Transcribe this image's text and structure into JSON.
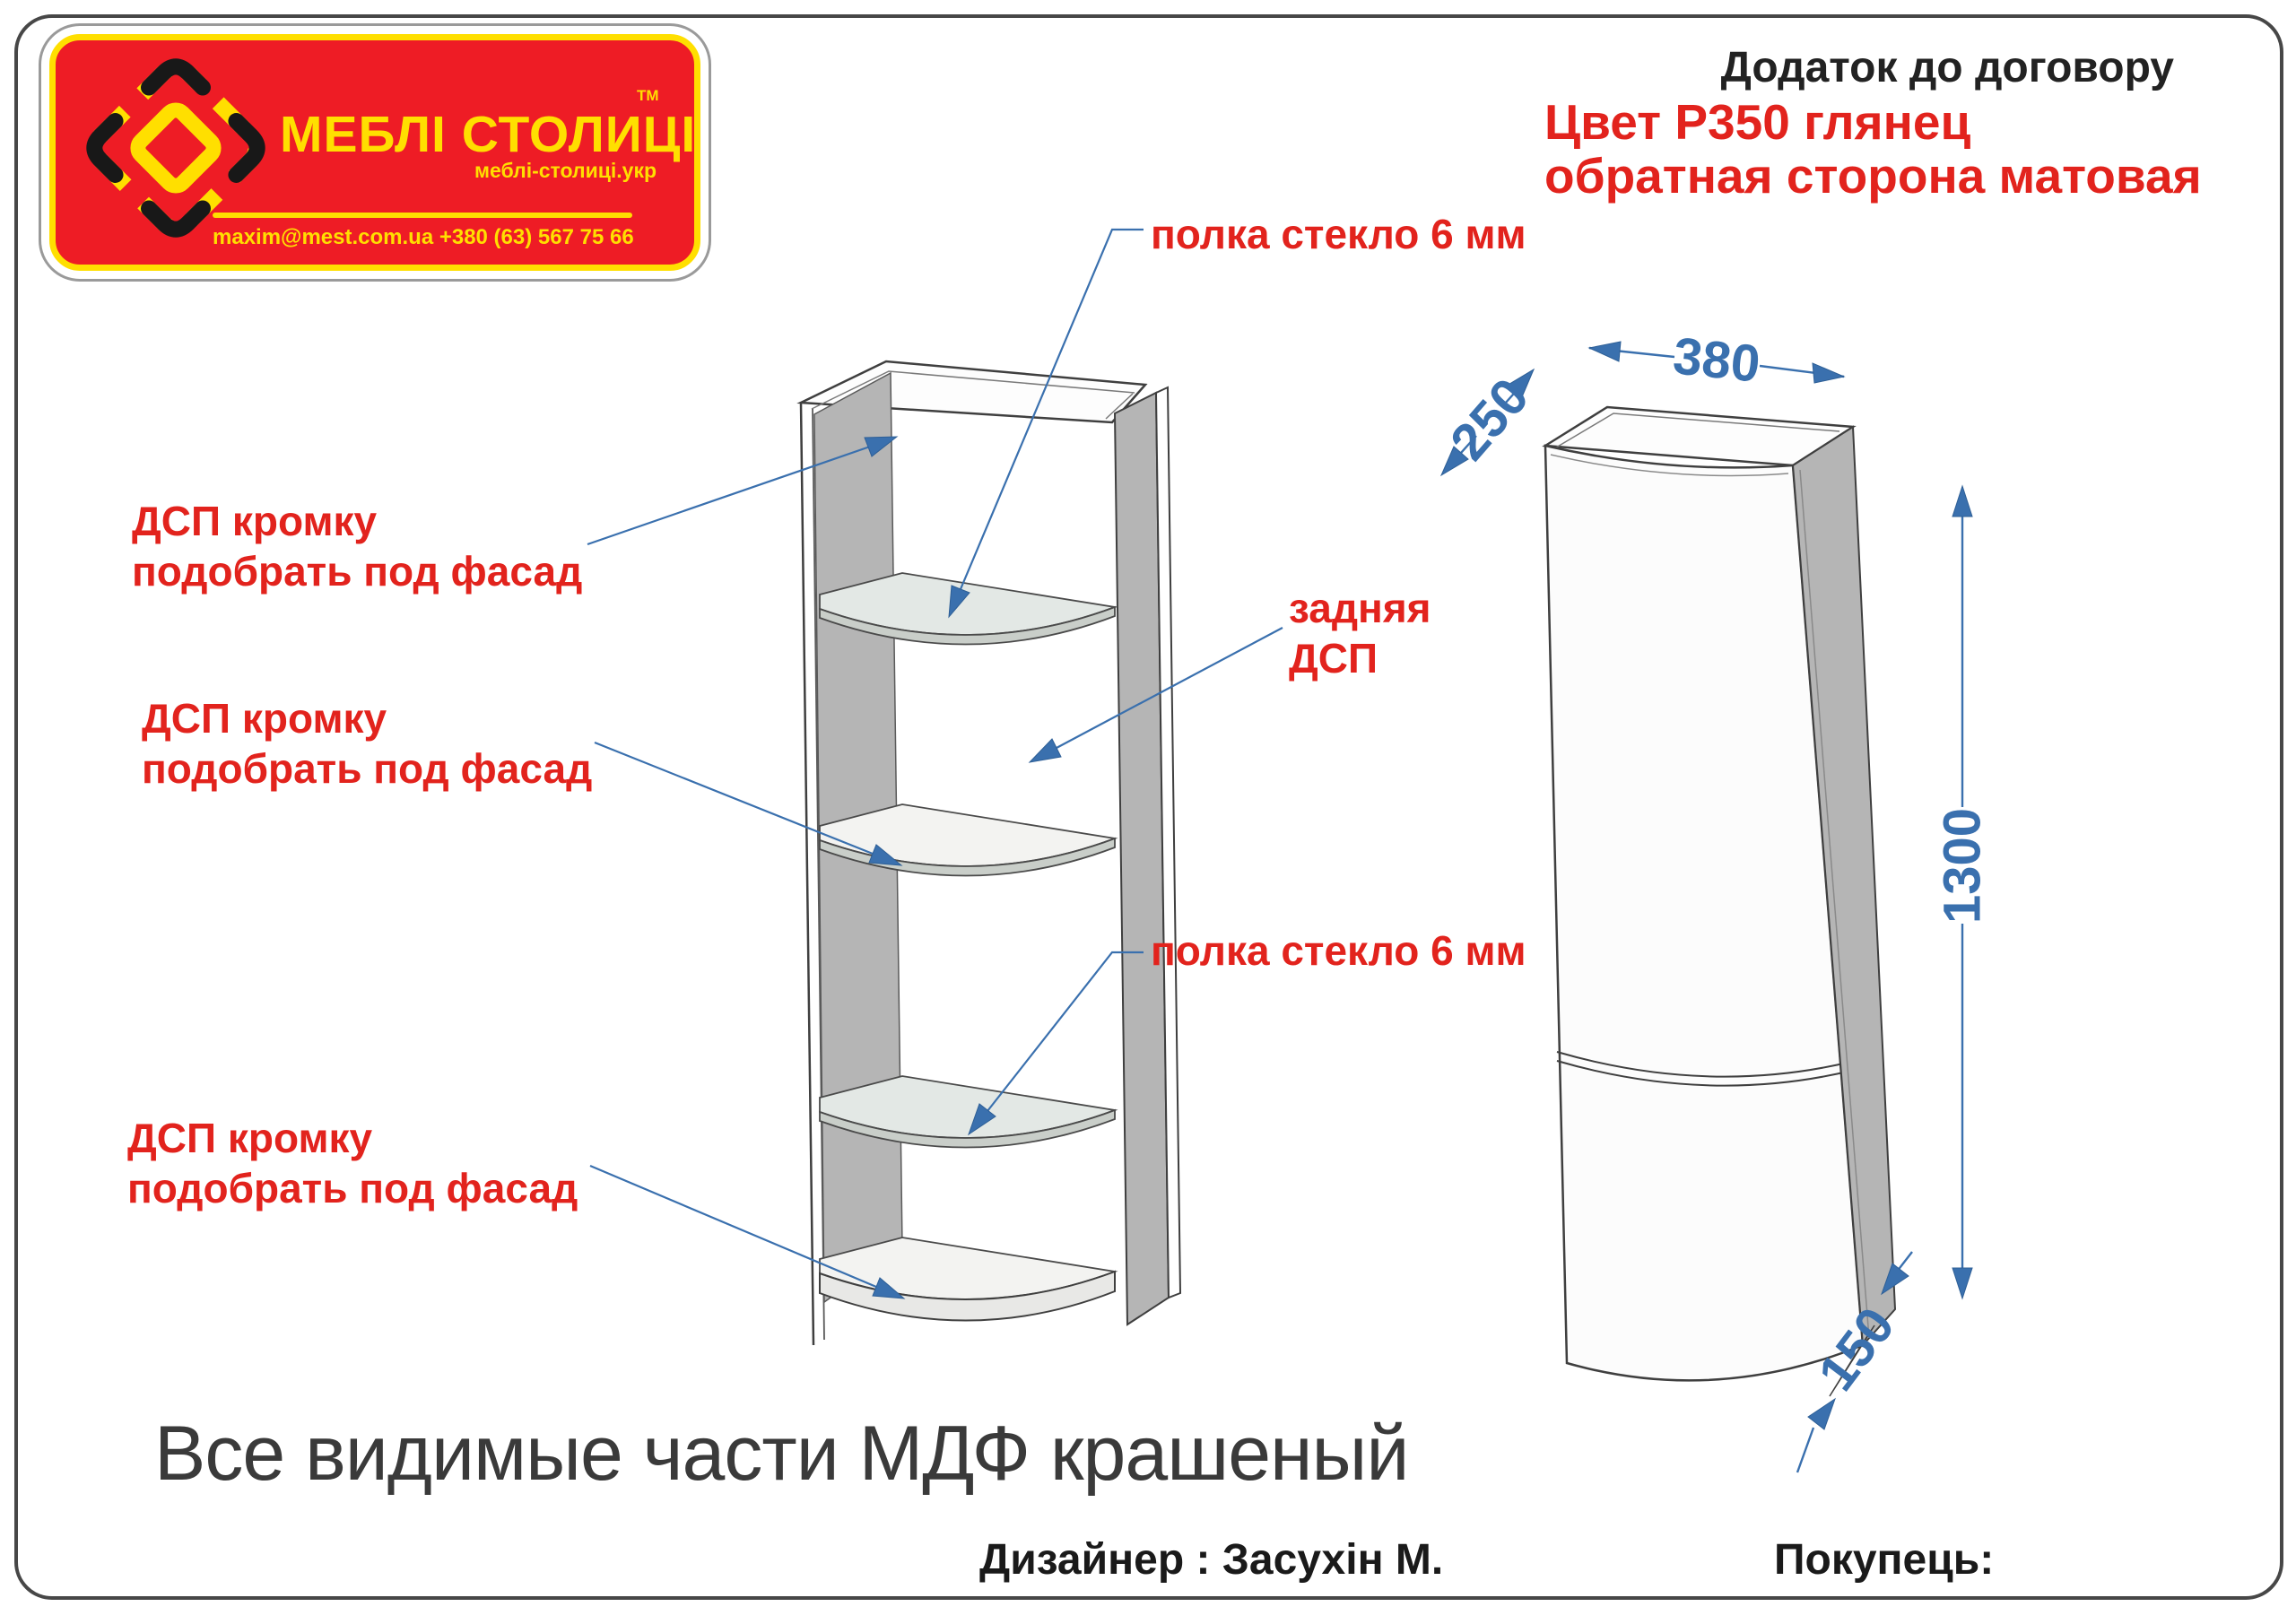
{
  "logo": {
    "brand": "МЕБЛІ СТОЛИЦІ",
    "tm": "ТМ",
    "site": "меблі-столиці.укр",
    "contact": "maxim@mest.com.ua  +380 (63) 567 75 66"
  },
  "header": {
    "doc_title": "Додаток до договору",
    "color_spec_line1": "Цвет Р350 глянец",
    "color_spec_line2": "обратная сторона матовая"
  },
  "annotations": {
    "glass_shelf_top": "полка стекло 6 мм",
    "glass_shelf_bottom": "полка стекло 6 мм",
    "dsp_edge_top_l1": "ДСП кромку",
    "dsp_edge_top_l2": "подобрать под фасад",
    "dsp_edge_mid_l1": "ДСП кромку",
    "dsp_edge_mid_l2": "подобрать под фасад",
    "dsp_edge_bot_l1": "ДСП кромку",
    "dsp_edge_bot_l2": "подобрать под фасад",
    "back_panel_l1": "задняя",
    "back_panel_l2": "ДСП"
  },
  "dimensions": {
    "width_mm": "380",
    "depth_mm": "250",
    "height_mm": "1300",
    "bottom_depth_mm": "150"
  },
  "footer": {
    "material_note": "Все видимые части МДФ крашеный",
    "designer": "Дизайнер : Засухін М.",
    "buyer": "Покупець:"
  },
  "colors": {
    "annotation_red": "#e2231d",
    "dimension_blue": "#3a70ae",
    "logo_red": "#ee1c25",
    "logo_yellow": "#ffdf00",
    "panel_gray": "#b5b5b5",
    "outline_gray": "#3f3f3f"
  }
}
